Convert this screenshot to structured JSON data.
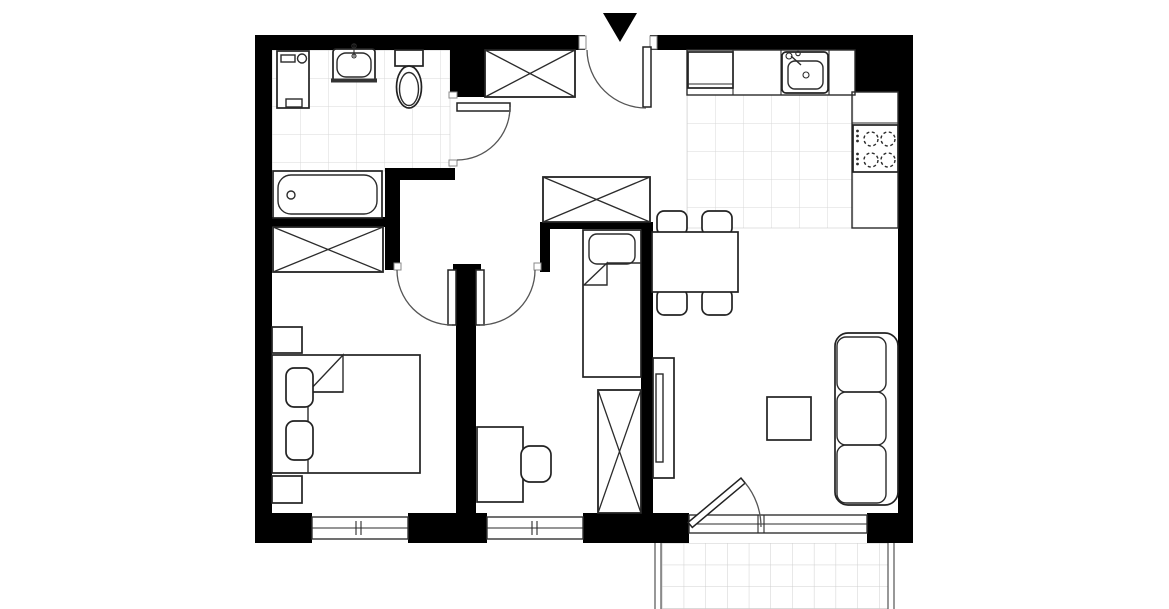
{
  "canvas": {
    "width": 1169,
    "height": 609,
    "background": "#ffffff"
  },
  "colors": {
    "wall": "#000000",
    "furniture_line": "#222222",
    "door_arc": "#555555",
    "bathroom_tile_line": "#d8d8d8",
    "kitchen_tile_line": "#d8d8d8",
    "balcony_tile_line": "#cfcfcf"
  },
  "entrance": {
    "marker": "black-triangle-pointing-down",
    "door": "single-swing-inward"
  },
  "rooms": [
    {
      "id": "bathroom",
      "position": "top-left",
      "floor": "tiled",
      "fixtures": [
        "washing-machine",
        "washbasin",
        "toilet",
        "bathtub"
      ]
    },
    {
      "id": "hallway",
      "position": "center",
      "floor": "plain",
      "fixtures": [
        "wardrobe-top",
        "wardrobe-lower"
      ]
    },
    {
      "id": "kitchen",
      "position": "top-right",
      "floor": "tiled",
      "fixtures": [
        "fridge",
        "countertop",
        "kitchen-sink",
        "stove-4-burners"
      ]
    },
    {
      "id": "dining-area",
      "position": "right-center",
      "floor": "plain",
      "fixtures": [
        "dining-table",
        "4-chairs"
      ]
    },
    {
      "id": "living-room",
      "position": "bottom-right",
      "floor": "plain",
      "fixtures": [
        "sofa-3-seat",
        "coffee-table",
        "tv-cabinet",
        "balcony-door"
      ]
    },
    {
      "id": "bedroom",
      "position": "bottom-left",
      "floor": "plain",
      "fixtures": [
        "double-bed",
        "2-pillows",
        "2-nightstands",
        "wardrobe",
        "window"
      ]
    },
    {
      "id": "kids-room",
      "position": "bottom-center",
      "floor": "plain",
      "fixtures": [
        "single-bed",
        "wardrobe",
        "desk",
        "desk-chair",
        "window"
      ]
    },
    {
      "id": "balcony",
      "position": "bottom",
      "floor": "tiled",
      "fixtures": [
        "balcony-railing-walls"
      ]
    }
  ],
  "doors": [
    "entrance-door",
    "bathroom-door",
    "bedroom-door",
    "kids-room-door",
    "balcony-door"
  ],
  "counts": {
    "windows": 3,
    "stove_burners": 4,
    "dining_chairs": 4,
    "sofa_seats": 3,
    "wardrobes": 4
  }
}
